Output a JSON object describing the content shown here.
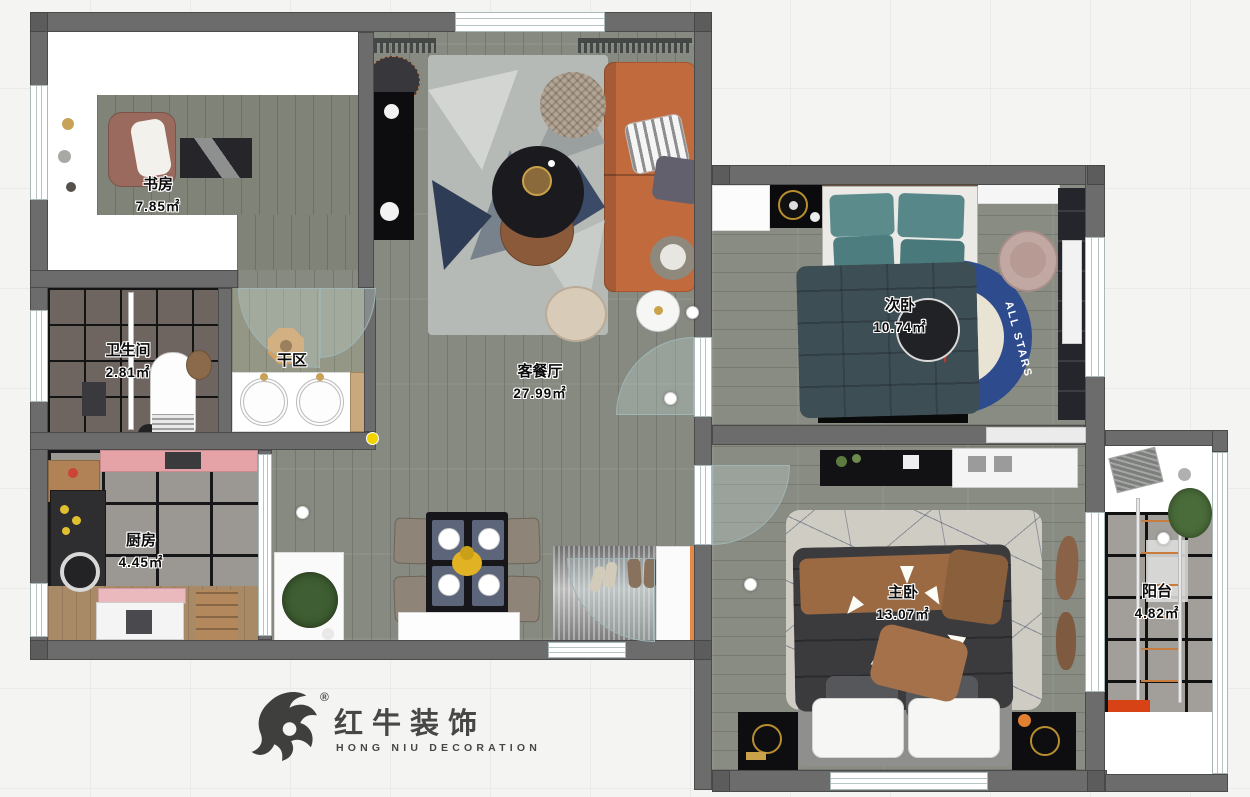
{
  "logo": {
    "cn": "红牛装饰",
    "en": "HONG NIU DECORATION",
    "reg": "®"
  },
  "rooms": {
    "study": {
      "name": "书房",
      "area": "7.85㎡"
    },
    "bathroom": {
      "name": "卫生间",
      "area": "2.81㎡"
    },
    "dry_area": {
      "name": "干区",
      "area": ""
    },
    "kitchen": {
      "name": "厨房",
      "area": "4.45㎡"
    },
    "living_dining": {
      "name": "客餐厅",
      "area": "27.99㎡"
    },
    "second_bedroom": {
      "name": "次卧",
      "area": "10.74㎡"
    },
    "master_bedroom": {
      "name": "主卧",
      "area": "13.07㎡"
    },
    "balcony": {
      "name": "阳台",
      "area": "4.82㎡"
    }
  },
  "decor": {
    "rug_text": "ALL STARS"
  },
  "colors": {
    "wall": "#6c6c6c",
    "wood_floor": "#868a80",
    "sofa_orange": "#c06a3e",
    "rug_navy": "#2e4b8e",
    "pillow_teal": "#5c8b8c",
    "counter_pink": "#e5a3a8",
    "accent_yellow": "#f0d400",
    "logo_gray": "#474745",
    "blanket_slate": "#3d4e54",
    "blanket_charcoal": "#3b3b3e",
    "blanket_brown": "#9b6a43"
  }
}
